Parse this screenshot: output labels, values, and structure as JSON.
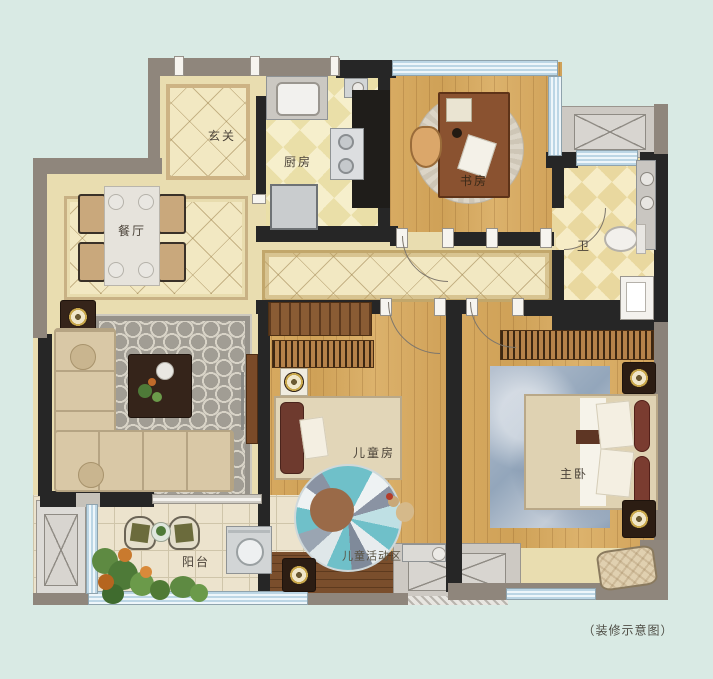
{
  "caption": "（装修示意图）",
  "rooms": {
    "foyer": {
      "label": "玄关"
    },
    "kitchen": {
      "label": "厨房"
    },
    "study": {
      "label": "书房"
    },
    "bath": {
      "label": "卫"
    },
    "dining": {
      "label": "餐厅"
    },
    "kids": {
      "label": "儿童房"
    },
    "kids_activity": {
      "label": "儿童活动区"
    },
    "master": {
      "label": "主卧"
    },
    "balcony": {
      "label": "阳台"
    }
  },
  "colors": {
    "background": "#d9eae4",
    "wall_dark": "#262626",
    "wall_gray": "#8f867c",
    "tile_beige": "#ecdfae",
    "wood": "#d2a45e",
    "walnut": "#7a4e2c",
    "window_glass": "#cfe3ee",
    "rug_living_gray": "#a19d94",
    "rug_master_blue": "#a3b2c4",
    "rug_kids_teal": "#6fc0c9",
    "accent_gold": "#c9a84c"
  }
}
